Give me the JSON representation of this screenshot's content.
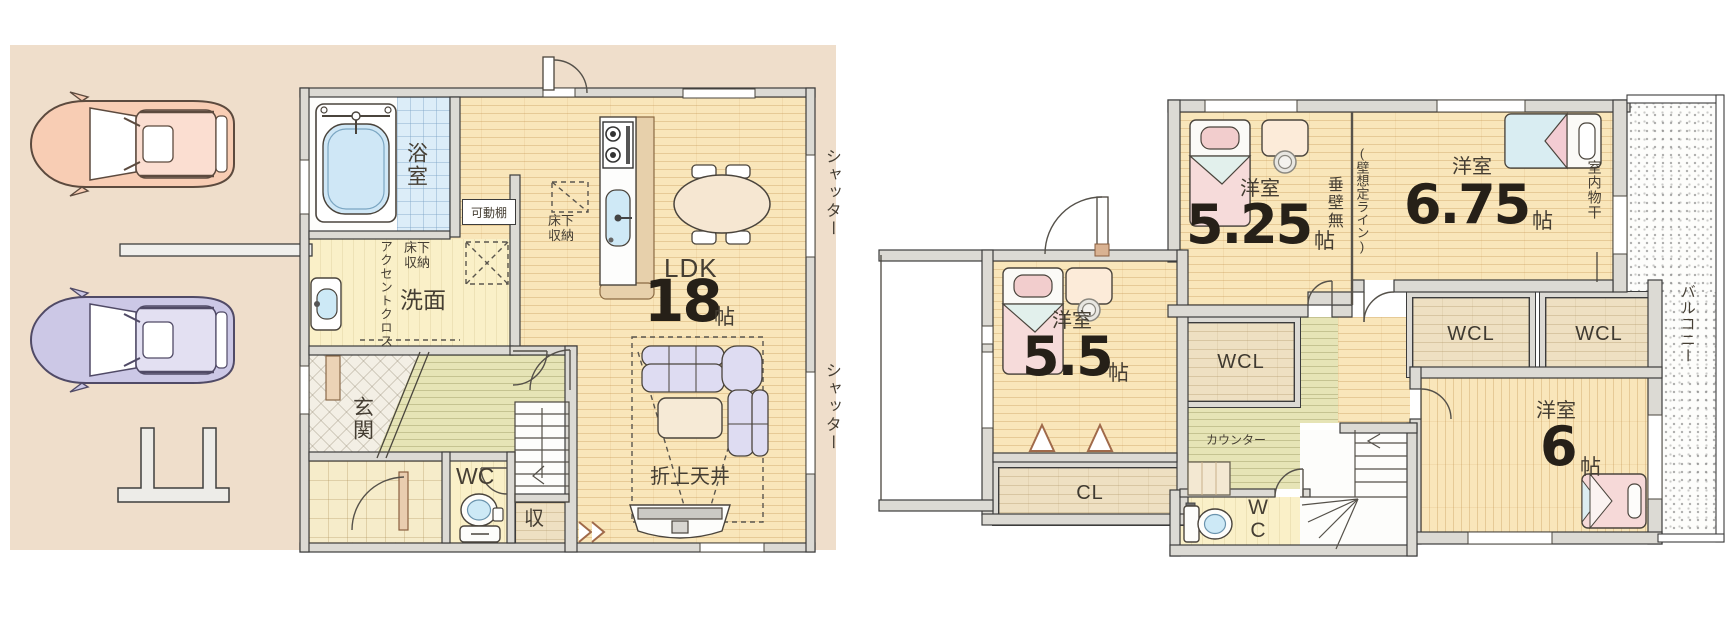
{
  "floor1": {
    "bath_label": "浴室",
    "movable_shelf_label": "可動棚",
    "washroom_underfloor_label": "床下収納",
    "kitchen_underfloor_label": "床下収納",
    "accent_cloth_label": "アクセントクロス",
    "washroom_label": "洗面",
    "entrance_label": "玄関",
    "wc_label": "WC",
    "storage_label": "収",
    "ldk_label": "LDK",
    "ldk_size": "18",
    "ldk_size_unit": "帖",
    "coffered_ceiling_label": "折上天井",
    "shutter_upper_label": "シャッター",
    "shutter_lower_label": "シャッター"
  },
  "floor2": {
    "room_525": {
      "type": "洋室",
      "size": "5.25",
      "unit": "帖"
    },
    "room_675": {
      "type": "洋室",
      "size": "6.75",
      "unit": "帖"
    },
    "room_55": {
      "type": "洋室",
      "size": "5.5",
      "unit": "帖"
    },
    "room_6": {
      "type": "洋室",
      "size": "6",
      "unit": "帖"
    },
    "hanging_wall_label": "垂壁無",
    "assumed_wall_line_label": "(壁想定ライン)",
    "indoor_drying_label": "室内物干",
    "wcl_center_label": "WCL",
    "wcl_east_label": "WCL",
    "wcl_far_east_label": "WCL",
    "cl_label": "CL",
    "counter_label": "カウンター",
    "wc_label": "WC",
    "balcony_label": "バルコニー"
  },
  "colors": {
    "lot_beige": "#efdecb",
    "wall_gray": "#dcdad4",
    "wood_floor": "#f9e6ba",
    "hall_green": "#e6e4b6",
    "washroom_yellow": "#faf0c8",
    "bath_tile_blue": "#dcedf8",
    "bed_pink": "#f6dbda",
    "sofa_lavender": "#dedcf2",
    "car1_salmon": "#f8cdb4",
    "car2_lavender": "#ccc8e6",
    "text_dark": "#262018"
  }
}
